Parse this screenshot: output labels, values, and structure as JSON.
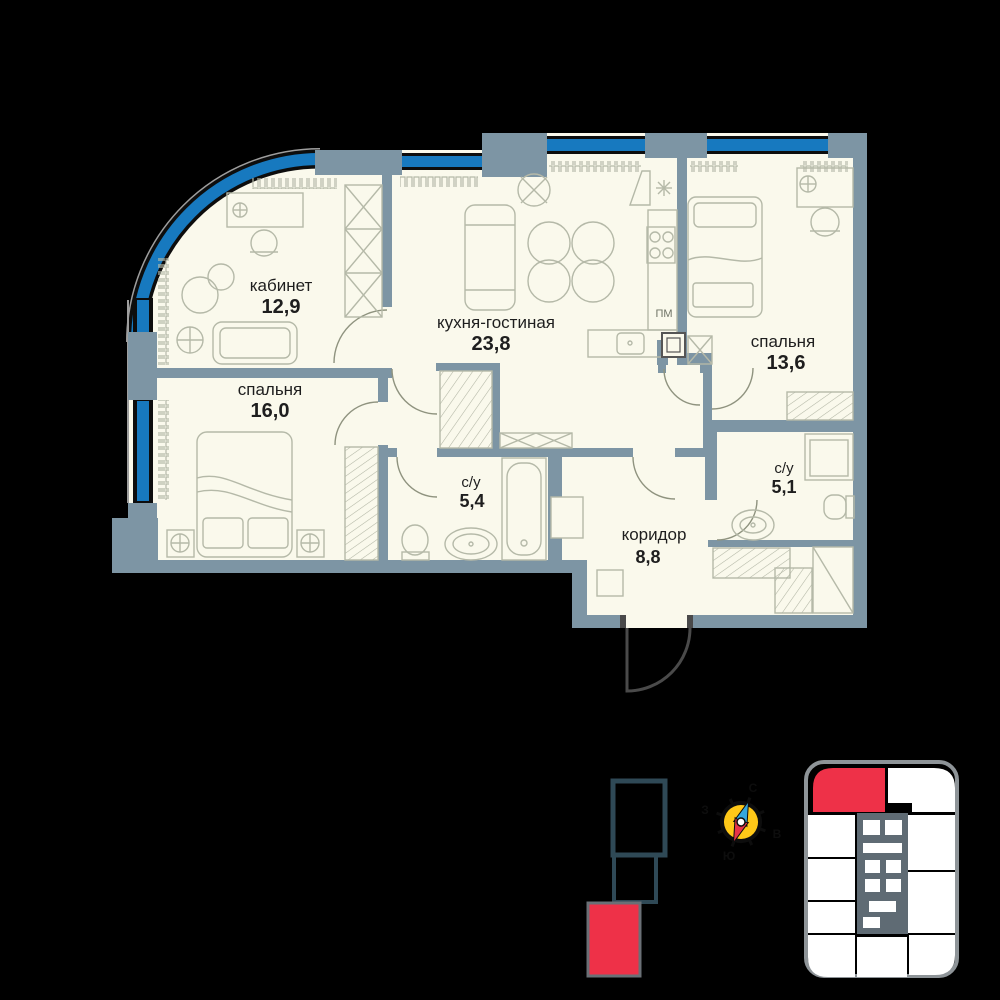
{
  "rooms": {
    "kabinet": {
      "name": "кабинет",
      "area": "12,9"
    },
    "kitchen_living": {
      "name": "кухня-гостиная",
      "area": "23,8"
    },
    "bedroom_right": {
      "name": "спальня",
      "area": "13,6"
    },
    "bedroom_left": {
      "name": "спальня",
      "area": "16,0"
    },
    "bathroom_small": {
      "name": "с/у",
      "area": "5,4"
    },
    "bathroom_right": {
      "name": "с/у",
      "area": "5,1"
    },
    "corridor": {
      "name": "коридор",
      "area": "8,8"
    }
  },
  "labels": {
    "dishwasher": "ПМ"
  },
  "compass": {
    "north": "С",
    "east": "В",
    "south": "Ю",
    "west": "З"
  },
  "colors": {
    "background": "#000000",
    "floor": "#FAF9EC",
    "wall": "#7D95A4",
    "glazing_blue": "#1779BF",
    "furniture_line": "#B5B9A8",
    "text": "#1E1E1E",
    "highlight_red": "#EE3148",
    "keyplan_core": "#5F6B74",
    "compass_yellow": "#FFC818",
    "compass_blue": "#35A7DD",
    "compass_red": "#E73348"
  }
}
